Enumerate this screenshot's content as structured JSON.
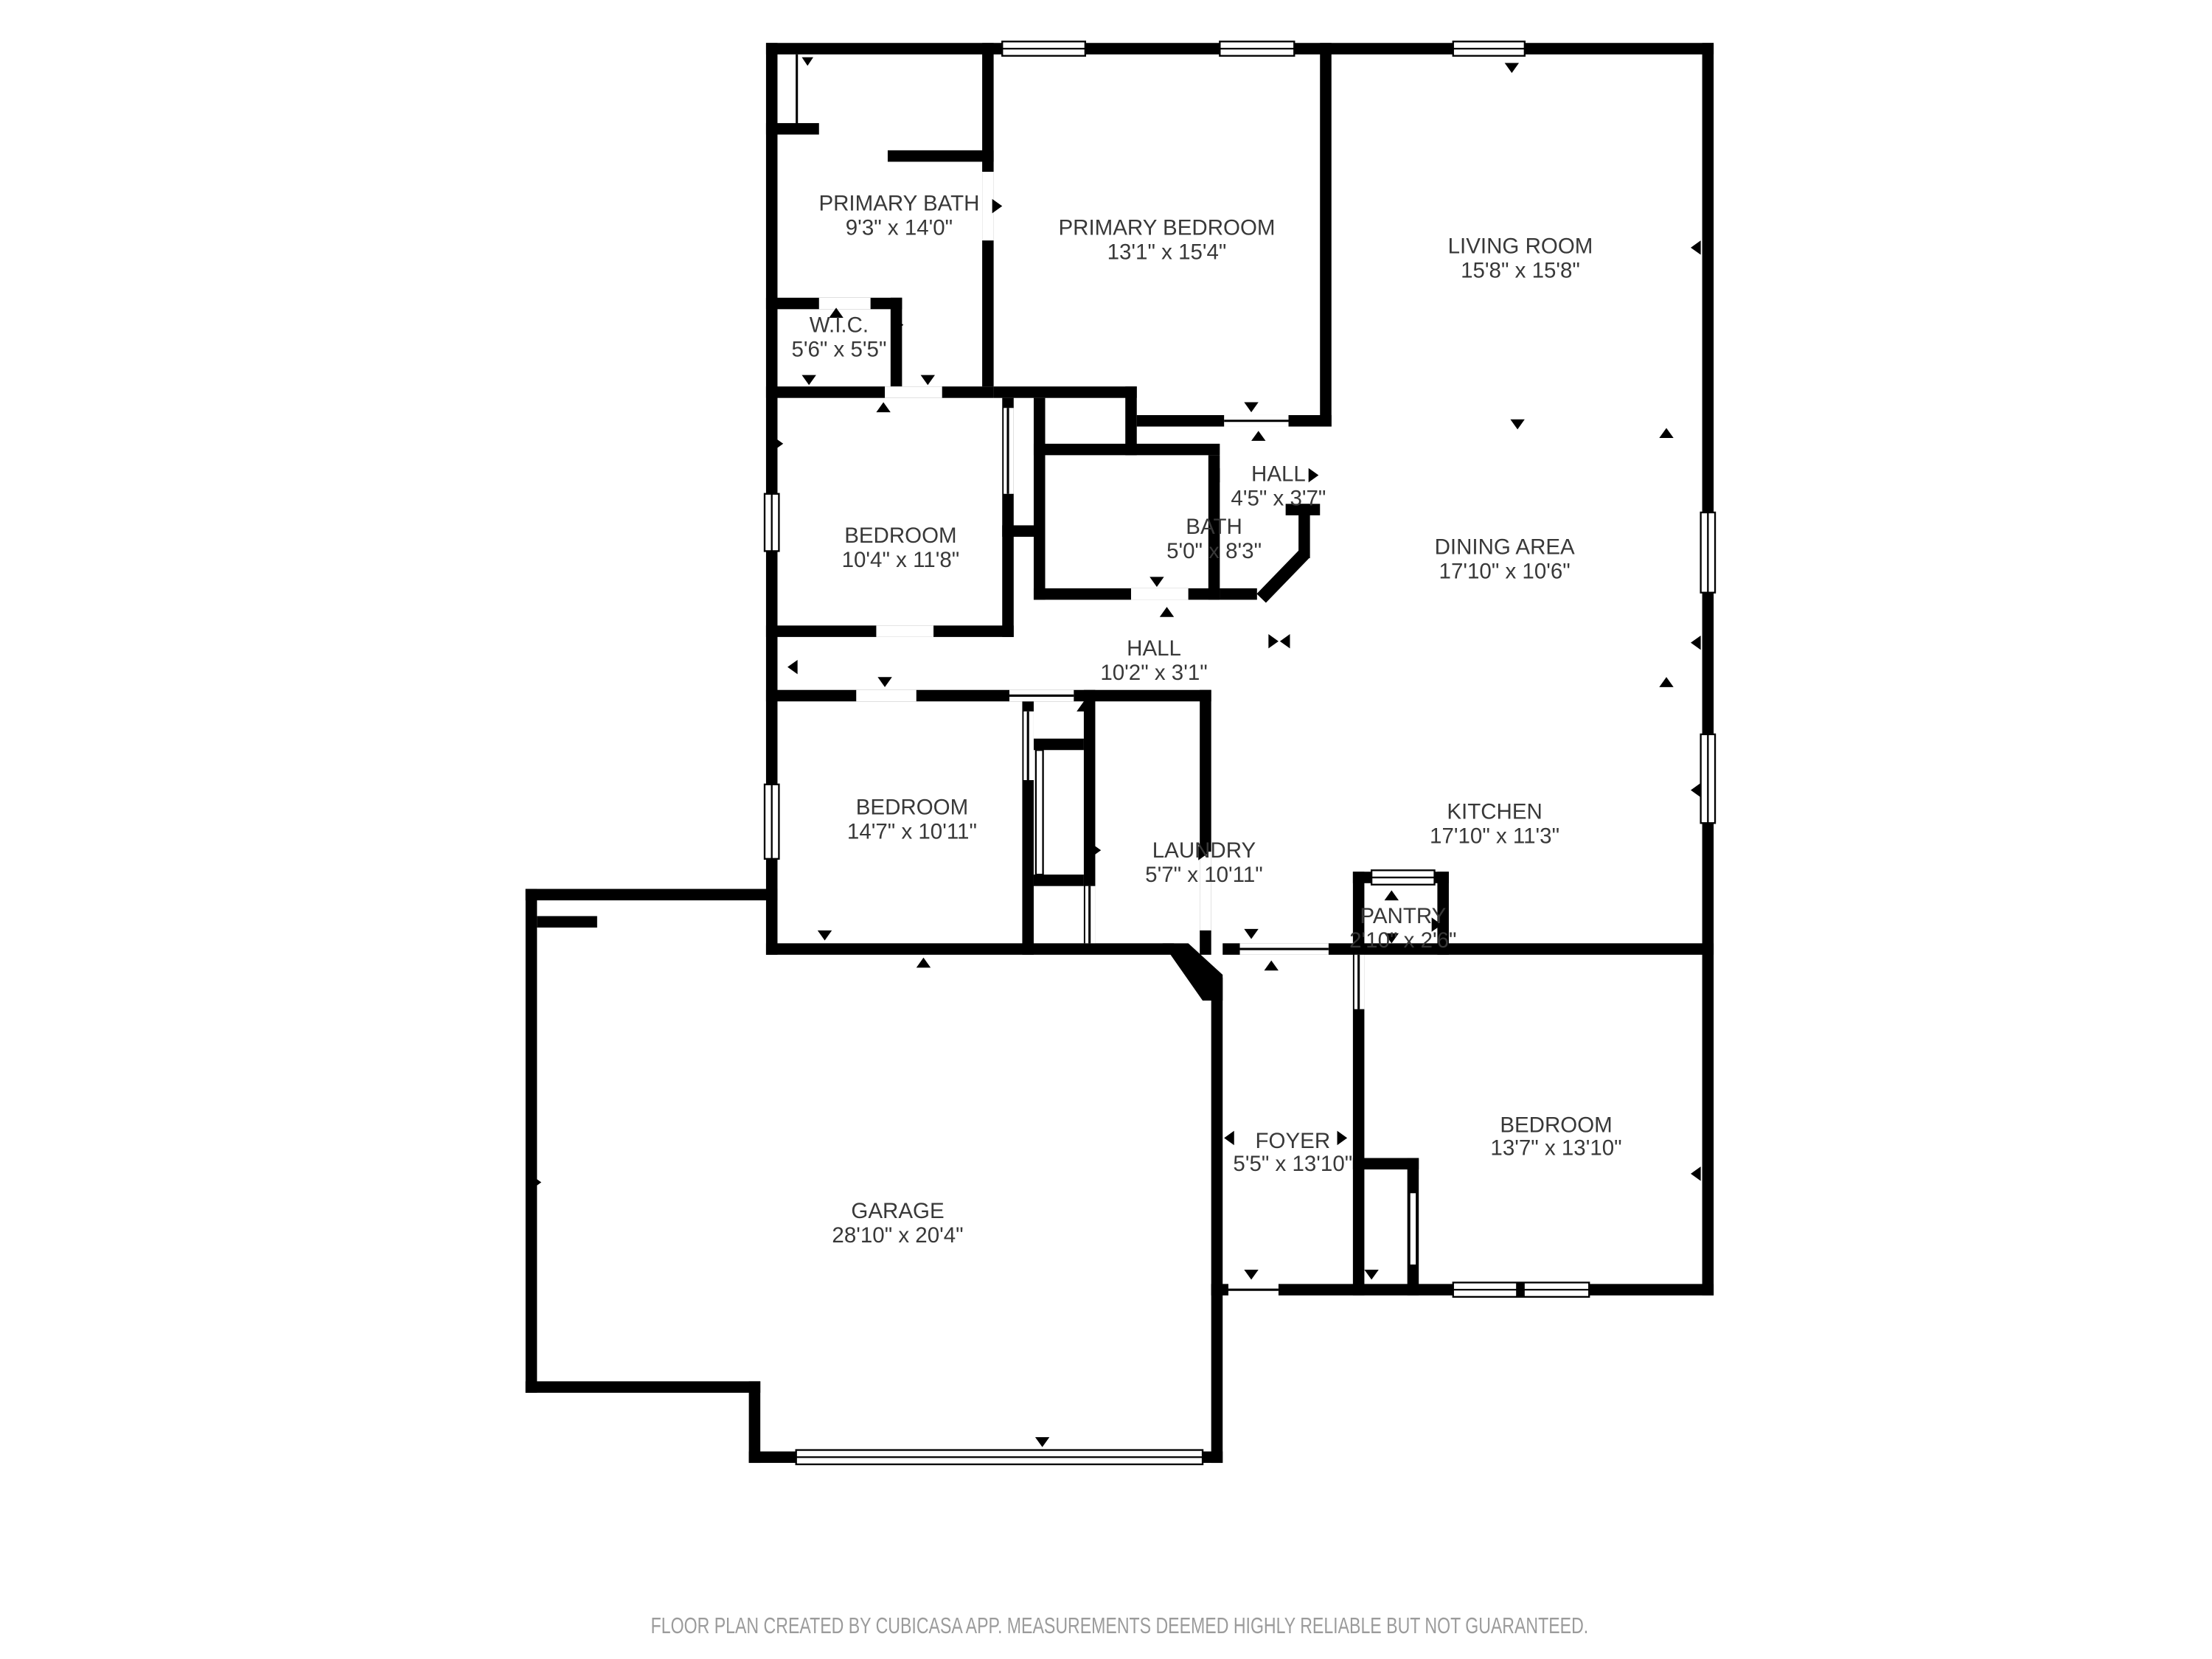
{
  "title": "Floor plan",
  "colors": {
    "wall": "#000000",
    "background": "#ffffff",
    "label": "#383838",
    "footer": "#9b9b9b"
  },
  "rooms": {
    "primary_bath": {
      "name": "PRIMARY BATH",
      "dims": "9'3\" x 14'0\""
    },
    "primary_bedroom": {
      "name": "PRIMARY BEDROOM",
      "dims": "13'1\" x 15'4\""
    },
    "living_room": {
      "name": "LIVING ROOM",
      "dims": "15'8\" x 15'8\""
    },
    "wic": {
      "name": "W.I.C.",
      "dims": "5'6\" x 5'5\""
    },
    "hall_upper": {
      "name": "HALL",
      "dims": "4'5\" x 3'7\""
    },
    "bedroom_left": {
      "name": "BEDROOM",
      "dims": "10'4\" x 11'8\""
    },
    "bath": {
      "name": "BATH",
      "dims": "5'0\" x 8'3\""
    },
    "dining_area": {
      "name": "DINING AREA",
      "dims": "17'10\" x 10'6\""
    },
    "hall_lower": {
      "name": "HALL",
      "dims": "10'2\" x 3'1\""
    },
    "bedroom_mid": {
      "name": "BEDROOM",
      "dims": "14'7\" x 10'11\""
    },
    "laundry": {
      "name": "LAUNDRY",
      "dims": "5'7\" x 10'11\""
    },
    "kitchen": {
      "name": "KITCHEN",
      "dims": "17'10\" x 11'3\""
    },
    "pantry": {
      "name": "PANTRY",
      "dims": "2'10\" x 2'6\""
    },
    "foyer": {
      "name": "FOYER",
      "dims": "5'5\" x 13'10\""
    },
    "bedroom_right": {
      "name": "BEDROOM",
      "dims": "13'7\" x 13'10\""
    },
    "garage": {
      "name": "GARAGE",
      "dims": "28'10\" x 20'4\""
    }
  },
  "footer": {
    "text": "FLOOR PLAN CREATED BY CUBICASA APP. MEASUREMENTS DEEMED HIGHLY RELIABLE BUT NOT GUARANTEED."
  }
}
